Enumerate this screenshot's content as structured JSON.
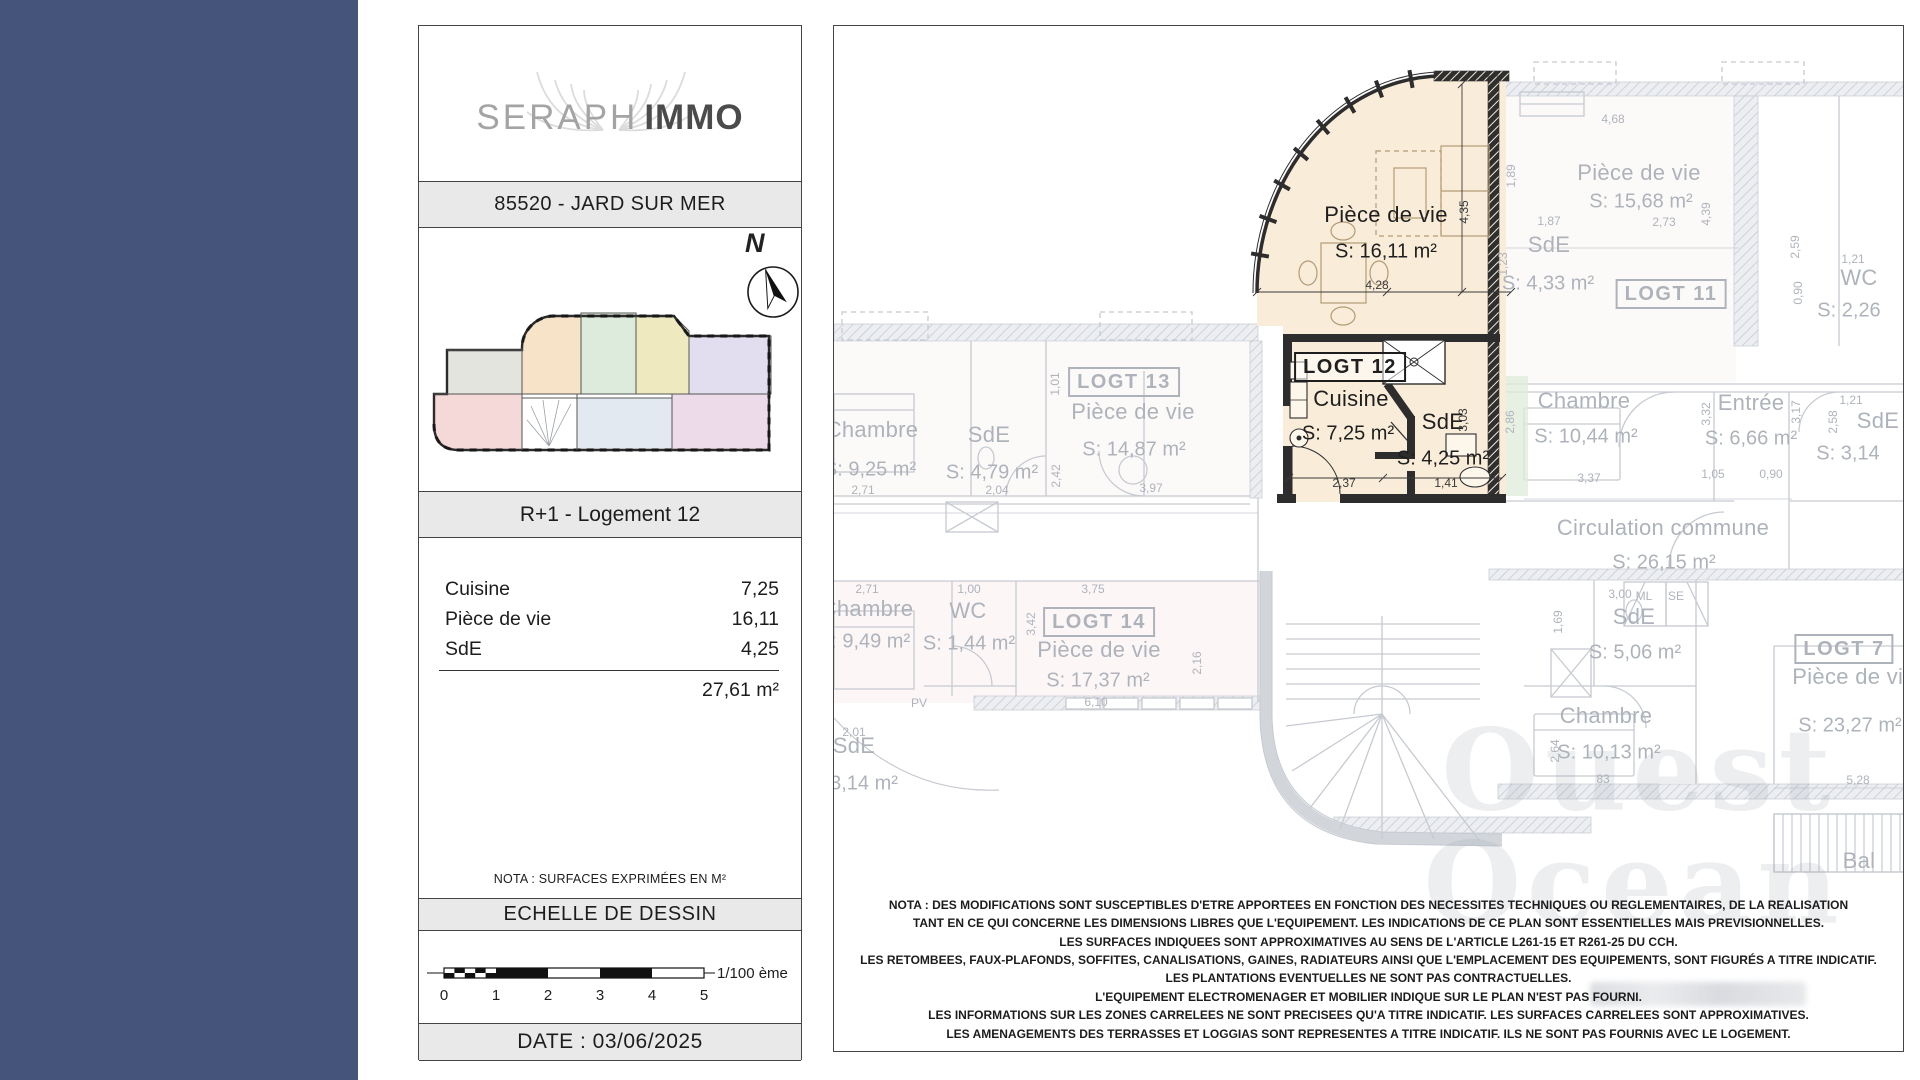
{
  "colors": {
    "sidebar": "#44547a",
    "bar_bg": "#e9e9e9",
    "highlight_fill": "#f9ecd9",
    "faded_text": "#aeb3bb"
  },
  "brand": {
    "name_light": "SERAPH",
    "name_bold": "IMMO"
  },
  "header": {
    "location": "85520 - JARD SUR MER",
    "level": "R+1 - Logement 12"
  },
  "north_label": "N",
  "surface_table": {
    "rows": [
      {
        "label": "Cuisine",
        "value": "7,25"
      },
      {
        "label": "Pièce de vie",
        "value": "16,11"
      },
      {
        "label": "SdE",
        "value": "4,25"
      }
    ],
    "total": "27,61 m²"
  },
  "nota": "NOTA : SURFACES EXPRIMÉES EN M²",
  "scale": {
    "title": "ECHELLE DE DESSIN",
    "ratio": "1/100 ème",
    "ticks": [
      "0",
      "1",
      "2",
      "3",
      "4",
      "5"
    ]
  },
  "date": "DATE : 03/06/2025",
  "plan": {
    "highlight_unit": "LOGT 12",
    "watermark": {
      "line1": "Ouest",
      "line2": "Ocean"
    },
    "labels": [
      {
        "t": "Pièce de vie",
        "c": "room",
        "x": 552,
        "y": 189,
        "h": true
      },
      {
        "t": "S: 16,11 m²",
        "c": "area",
        "x": 552,
        "y": 226,
        "h": true
      },
      {
        "t": "LOGT 12",
        "c": "box",
        "x": 516,
        "y": 341,
        "h": true
      },
      {
        "t": "Cuisine",
        "c": "room",
        "x": 517,
        "y": 373,
        "h": true
      },
      {
        "t": "S: 7,25 m²",
        "c": "area",
        "x": 514,
        "y": 408,
        "h": true
      },
      {
        "t": "SdE",
        "c": "room",
        "x": 609,
        "y": 396,
        "h": true
      },
      {
        "t": "S: 4,25 m²",
        "c": "area",
        "x": 609,
        "y": 433,
        "h": true
      },
      {
        "t": "4,28",
        "c": "dim",
        "x": 543,
        "y": 259,
        "h": true
      },
      {
        "t": "4,35",
        "c": "dimv",
        "x": 630,
        "y": 186,
        "h": true
      },
      {
        "t": "2,37",
        "c": "dim",
        "x": 510,
        "y": 457,
        "h": true
      },
      {
        "t": "1,41",
        "c": "dim",
        "x": 612,
        "y": 457,
        "h": true
      },
      {
        "t": "3,03",
        "c": "dimv",
        "x": 629,
        "y": 394,
        "h": true
      },
      {
        "t": "LOGT 13",
        "c": "box",
        "x": 290,
        "y": 356
      },
      {
        "t": "Pièce de vie",
        "c": "room",
        "x": 299,
        "y": 386
      },
      {
        "t": "S: 14,87 m²",
        "c": "area",
        "x": 300,
        "y": 424
      },
      {
        "t": "Chambre",
        "c": "room",
        "x": 38,
        "y": 404
      },
      {
        "t": "S: 9,25 m²",
        "c": "area",
        "x": 36,
        "y": 444
      },
      {
        "t": "2,71",
        "c": "dim",
        "x": 29,
        "y": 464
      },
      {
        "t": "SdE",
        "c": "room",
        "x": 155,
        "y": 409
      },
      {
        "t": "S: 4,79 m²",
        "c": "area",
        "x": 158,
        "y": 447
      },
      {
        "t": "2,04",
        "c": "dim",
        "x": 163,
        "y": 464
      },
      {
        "t": "2,42",
        "c": "dimv",
        "x": 222,
        "y": 450
      },
      {
        "t": "1,01",
        "c": "dimv",
        "x": 221,
        "y": 358
      },
      {
        "t": "3,97",
        "c": "dim",
        "x": 317,
        "y": 462
      },
      {
        "t": "Chambre",
        "c": "room",
        "x": 33,
        "y": 583
      },
      {
        "t": "S: 9,49 m²",
        "c": "area",
        "x": 30,
        "y": 616
      },
      {
        "t": "2,71",
        "c": "dim",
        "x": 33,
        "y": 563
      },
      {
        "t": "WC",
        "c": "room",
        "x": 134,
        "y": 585
      },
      {
        "t": "S: 1,44 m²",
        "c": "area",
        "x": 135,
        "y": 618
      },
      {
        "t": "1,00",
        "c": "dim",
        "x": 135,
        "y": 563
      },
      {
        "t": "LOGT 14",
        "c": "box",
        "x": 265,
        "y": 596
      },
      {
        "t": "Pièce de vie",
        "c": "room",
        "x": 265,
        "y": 624
      },
      {
        "t": "S: 17,37 m²",
        "c": "area",
        "x": 264,
        "y": 655
      },
      {
        "t": "3,75",
        "c": "dim",
        "x": 259,
        "y": 563
      },
      {
        "t": "3,42",
        "c": "dimv",
        "x": 197,
        "y": 598
      },
      {
        "t": "6,10",
        "c": "dim",
        "x": 262,
        "y": 676
      },
      {
        "t": "2,16",
        "c": "dimv",
        "x": 363,
        "y": 637
      },
      {
        "t": "PV",
        "c": "dim",
        "x": 85,
        "y": 677
      },
      {
        "t": "SdE",
        "c": "room",
        "x": 20,
        "y": 720
      },
      {
        "t": "3,14 m²",
        "c": "area",
        "x": 30,
        "y": 758
      },
      {
        "t": "2,01",
        "c": "dim",
        "x": 20,
        "y": 706
      },
      {
        "t": "Pièce de vie",
        "c": "room",
        "x": 805,
        "y": 147
      },
      {
        "t": "S: 15,68 m²",
        "c": "area",
        "x": 807,
        "y": 176
      },
      {
        "t": "4,68",
        "c": "dim",
        "x": 779,
        "y": 93
      },
      {
        "t": "1,89",
        "c": "dimv",
        "x": 677,
        "y": 150
      },
      {
        "t": "1,87",
        "c": "dim",
        "x": 715,
        "y": 195
      },
      {
        "t": "2,73",
        "c": "dim",
        "x": 830,
        "y": 196
      },
      {
        "t": "4,39",
        "c": "dimv",
        "x": 872,
        "y": 188
      },
      {
        "t": "SdE",
        "c": "room",
        "x": 715,
        "y": 219
      },
      {
        "t": "S: 4,33 m²",
        "c": "area",
        "x": 714,
        "y": 258
      },
      {
        "t": "1,23",
        "c": "dimv",
        "x": 669,
        "y": 238
      },
      {
        "t": "LOGT 11",
        "c": "box",
        "x": 837,
        "y": 268
      },
      {
        "t": "WC",
        "c": "room",
        "x": 1025,
        "y": 252
      },
      {
        "t": "1,21",
        "c": "dim",
        "x": 1019,
        "y": 233
      },
      {
        "t": "S: 2,26",
        "c": "area",
        "x": 1015,
        "y": 285
      },
      {
        "t": "2,59",
        "c": "dimv",
        "x": 961,
        "y": 221
      },
      {
        "t": "0,90",
        "c": "dimv",
        "x": 964,
        "y": 267
      },
      {
        "t": "Chambre",
        "c": "room",
        "x": 750,
        "y": 375
      },
      {
        "t": "S: 10,44 m²",
        "c": "area",
        "x": 752,
        "y": 411
      },
      {
        "t": "2,86",
        "c": "dimv",
        "x": 676,
        "y": 396
      },
      {
        "t": "3,37",
        "c": "dim",
        "x": 755,
        "y": 452
      },
      {
        "t": "Entrée",
        "c": "room",
        "x": 917,
        "y": 377
      },
      {
        "t": "S: 6,66 m²",
        "c": "area",
        "x": 917,
        "y": 413
      },
      {
        "t": "3,32",
        "c": "dimv",
        "x": 872,
        "y": 388
      },
      {
        "t": "3,17",
        "c": "dimv",
        "x": 962,
        "y": 386
      },
      {
        "t": "1,05",
        "c": "dim",
        "x": 879,
        "y": 448
      },
      {
        "t": "0,90",
        "c": "dim",
        "x": 937,
        "y": 448
      },
      {
        "t": "SdE",
        "c": "room",
        "x": 1044,
        "y": 395
      },
      {
        "t": "2,58",
        "c": "dimv",
        "x": 999,
        "y": 396
      },
      {
        "t": "1,21",
        "c": "dim",
        "x": 1017,
        "y": 374
      },
      {
        "t": "S: 3,14",
        "c": "area",
        "x": 1014,
        "y": 428
      },
      {
        "t": "Circulation commune",
        "c": "room",
        "x": 829,
        "y": 502
      },
      {
        "t": "S: 26,15 m²",
        "c": "area",
        "x": 830,
        "y": 537
      },
      {
        "t": "3,00",
        "c": "dim",
        "x": 786,
        "y": 568
      },
      {
        "t": "SdE",
        "c": "room",
        "x": 800,
        "y": 591
      },
      {
        "t": "S: 5,06 m²",
        "c": "area",
        "x": 801,
        "y": 627
      },
      {
        "t": "1,69",
        "c": "dimv",
        "x": 724,
        "y": 596
      },
      {
        "t": "ML",
        "c": "dim",
        "x": 810,
        "y": 570
      },
      {
        "t": "SE",
        "c": "dim",
        "x": 842,
        "y": 570
      },
      {
        "t": "LOGT 7",
        "c": "box",
        "x": 1010,
        "y": 623
      },
      {
        "t": "Pièce de vie",
        "c": "room",
        "x": 1020,
        "y": 651
      },
      {
        "t": "S: 23,27 m²",
        "c": "area",
        "x": 1016,
        "y": 700
      },
      {
        "t": "Chambre",
        "c": "room",
        "x": 772,
        "y": 690
      },
      {
        "t": "S: 10,13 m²",
        "c": "area",
        "x": 775,
        "y": 727
      },
      {
        "t": "2,64",
        "c": "dimv",
        "x": 721,
        "y": 725
      },
      {
        "t": "83",
        "c": "dim",
        "x": 769,
        "y": 753
      },
      {
        "t": "5,28",
        "c": "dim",
        "x": 1024,
        "y": 754
      },
      {
        "t": "Bal",
        "c": "room",
        "x": 1025,
        "y": 835
      }
    ]
  },
  "legal": {
    "lines": [
      "NOTA : DES MODIFICATIONS SONT SUSCEPTIBLES D'ETRE APPORTEES EN FONCTION DES NECESSITES TECHNIQUES OU REGLEMENTAIRES, DE LA REALISATION",
      "TANT EN CE QUI CONCERNE LES DIMENSIONS LIBRES QUE L'EQUIPEMENT. LES INDICATIONS DE CE PLAN SONT ESSENTIELLES MAIS PREVISIONNELLES.",
      "LES SURFACES INDIQUEES SONT APPROXIMATIVES AU SENS DE L'ARTICLE L261-15 ET R261-25 DU CCH.",
      "LES RETOMBEES, FAUX-PLAFONDS, SOFFITES, CANALISATIONS, GAINES, RADIATEURS AINSI QUE L'EMPLACEMENT DES EQUIPEMENTS, SONT FIGURÉS A TITRE INDICATIF.",
      "LES PLANTATIONS EVENTUELLES NE SONT PAS CONTRACTUELLES.",
      "L'EQUIPEMENT ELECTROMENAGER ET MOBILIER INDIQUE SUR LE PLAN N'EST PAS FOURNI.",
      "LES INFORMATIONS SUR LES ZONES CARRELEES NE SONT PRECISEES QU'A TITRE INDICATIF. LES SURFACES CARRELEES SONT APPROXIMATIVES.",
      "LES AMENAGEMENTS DES TERRASSES ET LOGGIAS SONT REPRESENTES A TITRE INDICATIF. ILS NE SONT PAS FOURNIS AVEC LE LOGEMENT."
    ]
  }
}
